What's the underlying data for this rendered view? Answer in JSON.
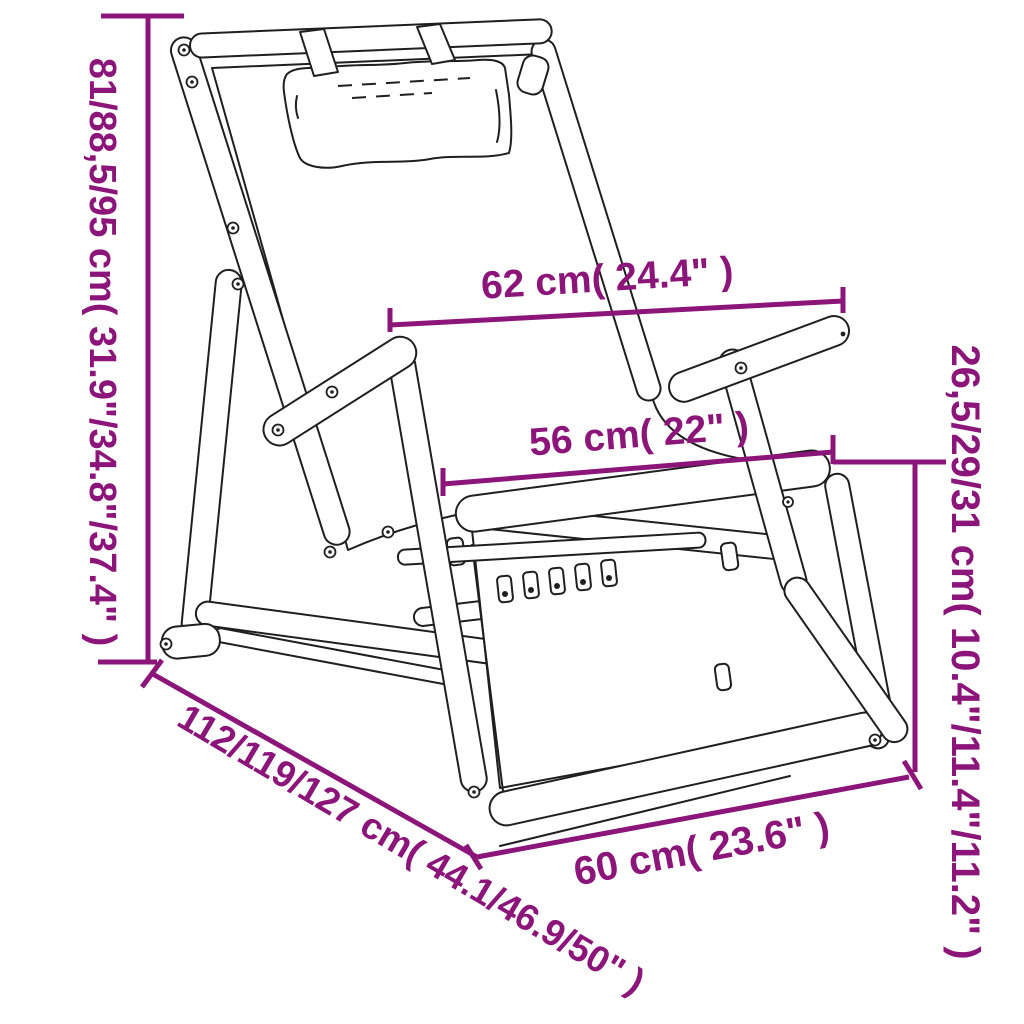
{
  "title": "Folding deck chair dimension diagram",
  "colors": {
    "dimension_accent": "#8C1579",
    "line_art": "#1F1F1F",
    "background": "#FFFFFF"
  },
  "chair": {
    "parts": [
      "headrest-pillow",
      "backrest-frame",
      "armrests",
      "seat",
      "folding-legs",
      "ground-runners",
      "recline-adjustment-rack"
    ]
  },
  "dimensions": {
    "total_height": {
      "label": "81/88,5/95 cm( 31.9\"/34.8\"/37.4\" )",
      "cm": [
        81,
        88.5,
        95
      ],
      "inches": [
        31.9,
        34.8,
        37.4
      ],
      "position": "left-vertical"
    },
    "back_width": {
      "label": "62 cm( 24.4\" )",
      "cm": [
        62
      ],
      "inches": [
        24.4
      ],
      "position": "top-horizontal"
    },
    "seat_width": {
      "label": "56 cm( 22\" )",
      "cm": [
        56
      ],
      "inches": [
        22
      ],
      "position": "middle-horizontal"
    },
    "seat_height": {
      "label": "26,5/29/31 cm( 10.4\"/11.4\"/11.2\" )",
      "cm": [
        26.5,
        29,
        31
      ],
      "inches": [
        10.4,
        11.4,
        11.2
      ],
      "position": "right-vertical"
    },
    "total_depth": {
      "label": "112/119/127 cm( 44.1/46.9/50\" )",
      "cm": [
        112,
        119,
        127
      ],
      "inches": [
        44.1,
        46.9,
        50
      ],
      "position": "bottom-left-diagonal"
    },
    "front_width": {
      "label": "60 cm( 23.6\" )",
      "cm": [
        60
      ],
      "inches": [
        23.6
      ],
      "position": "bottom-horizontal"
    }
  }
}
